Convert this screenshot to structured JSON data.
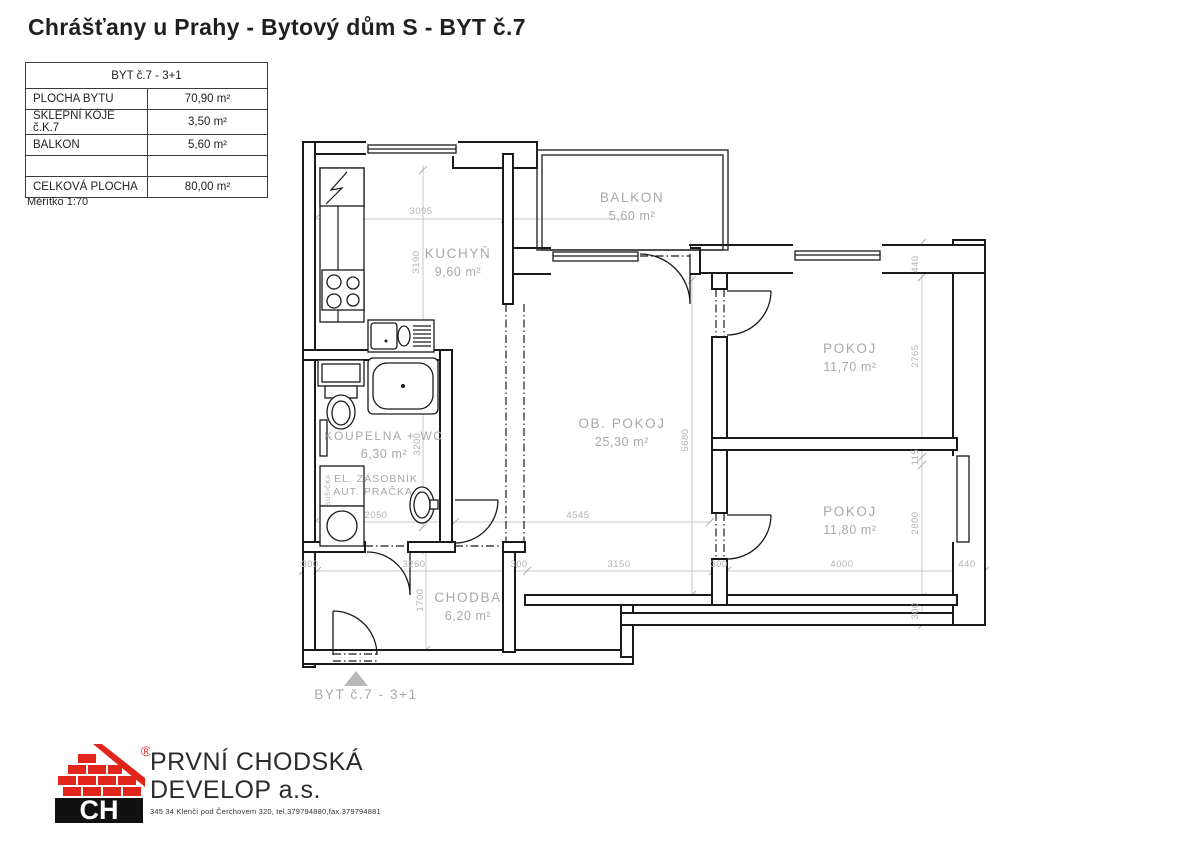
{
  "title": "Chrášťany u Prahy - Bytový dům S - BYT č.7",
  "info_table": {
    "header": "BYT č.7 - 3+1",
    "rows": [
      {
        "label": "PLOCHA BYTU",
        "value": "70,90 m²"
      },
      {
        "label": "SKLEPNÍ KÓJE č.K.7",
        "value": "3,50 m²"
      },
      {
        "label": "BALKON",
        "value": "5,60 m²"
      },
      {
        "label": "",
        "value": ""
      },
      {
        "label": "CELKOVÁ PLOCHA",
        "value": "80,00 m²"
      }
    ],
    "scale_note": "Měřítko 1:70"
  },
  "floorplan": {
    "rooms": [
      {
        "name": "KUCHYŇ",
        "area": "9,60 m²"
      },
      {
        "name": "BALKON",
        "area": "5,60 m²"
      },
      {
        "name": "OB. POKOJ",
        "area": "25,30 m²"
      },
      {
        "name": "POKOJ",
        "area": "11,70 m²"
      },
      {
        "name": "POKOJ",
        "area": "11,80 m²"
      },
      {
        "name": "KOUPELNA + WC",
        "area": "6,30 m²"
      },
      {
        "name": "CHODBA",
        "area": "6,20 m²"
      }
    ],
    "equipment": {
      "line1": "EL. ZÁSOBNÍK",
      "line2": "AUT. PRAČKA",
      "dryer": "SUŠIČKA"
    },
    "entrance_label": "BYT č.7 - 3+1",
    "dims": {
      "kitchen_w": "3095",
      "kitchen_h": "3190",
      "bath_h": "3200",
      "bath_w": "2050",
      "living_w": "4545",
      "living_h": "5680",
      "hall_h": "1700",
      "bot_300a": "300",
      "hall_w": "3260",
      "bot_300b": "300",
      "living_bw": "3150",
      "bot_300c": "300",
      "room2_w": "4000",
      "bot_440": "440",
      "right_440": "440",
      "room1_h": "2765",
      "right_115": "115",
      "room2_h": "2800",
      "right_300": "300"
    }
  },
  "footer": {
    "logo_text": "CH",
    "registered": "®",
    "company_line1": "PRVNÍ CHODSKÁ",
    "company_line2": "DEVELOP a.s.",
    "address": "345 34 Klenčí pod Čerchovem 320, tel.379794880,fax.379794881"
  },
  "colors": {
    "brand_red": "#e1251b",
    "wall_black": "#1a1a1a",
    "plan_gray": "#a8a8a8"
  }
}
